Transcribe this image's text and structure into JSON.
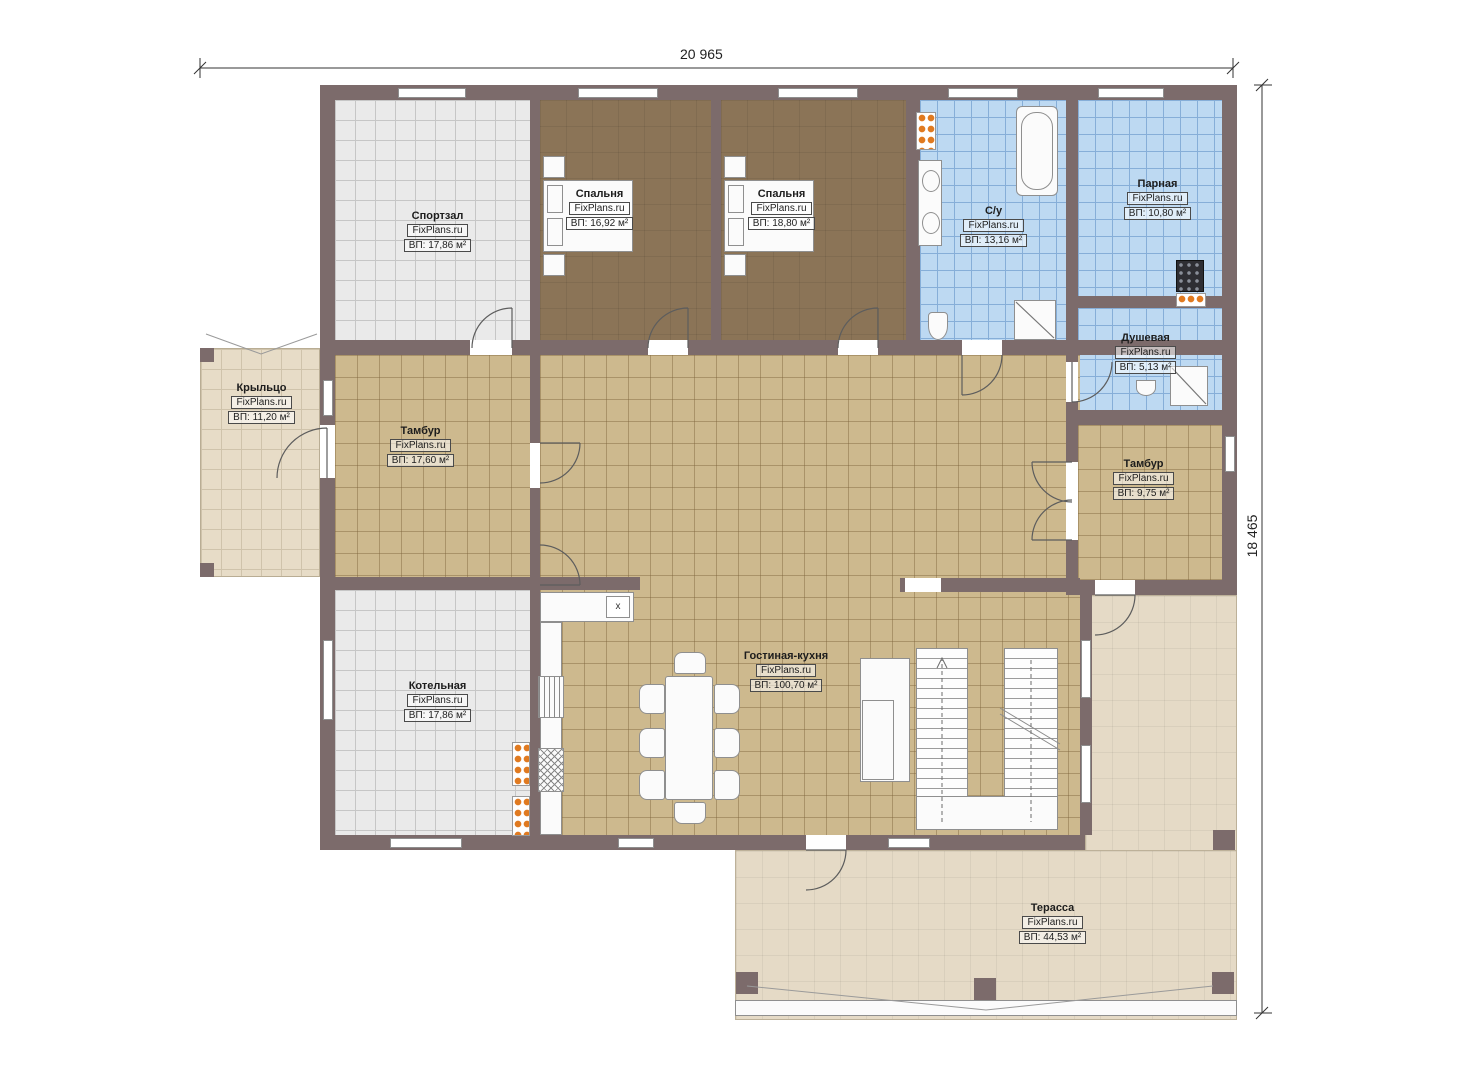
{
  "dimensions": {
    "width_label": "20 965",
    "height_label": "18 465"
  },
  "rooms": [
    {
      "name": "Спортзал",
      "watermark": "FixPlans.ru",
      "area": "ВП: 17,86 м²"
    },
    {
      "name": "Спальня",
      "watermark": "FixPlans.ru",
      "area": "ВП: 16,92 м²"
    },
    {
      "name": "Спальня",
      "watermark": "FixPlans.ru",
      "area": "ВП: 18,80 м²"
    },
    {
      "name": "С/у",
      "watermark": "FixPlans.ru",
      "area": "ВП: 13,16 м²"
    },
    {
      "name": "Парная",
      "watermark": "FixPlans.ru",
      "area": "ВП: 10,80 м²"
    },
    {
      "name": "Душевая",
      "watermark": "FixPlans.ru",
      "area": "ВП: 5,13 м²"
    },
    {
      "name": "Крыльцо",
      "watermark": "FixPlans.ru",
      "area": "ВП: 11,20 м²"
    },
    {
      "name": "Тамбур",
      "watermark": "FixPlans.ru",
      "area": "ВП: 17,60 м²"
    },
    {
      "name": "Тамбур",
      "watermark": "FixPlans.ru",
      "area": "ВП: 9,75 м²"
    },
    {
      "name": "Котельная",
      "watermark": "FixPlans.ru",
      "area": "ВП: 17,86 м²"
    },
    {
      "name": "Гостиная-кухня",
      "watermark": "FixPlans.ru",
      "area": "ВП: 100,70 м²"
    },
    {
      "name": "Терасса",
      "watermark": "FixPlans.ru",
      "area": "ВП: 44,53 м²"
    }
  ],
  "kitchen": {
    "sink_label": "x"
  },
  "colors": {
    "wall": "#7c6b6b",
    "floor_tan": "#cdb98e",
    "floor_blue": "#bdd9f2",
    "floor_brown": "#8b7457",
    "floor_gray": "#eaeaea",
    "floor_beige": "#e7dcc7",
    "accent_orange": "#e07a20"
  }
}
